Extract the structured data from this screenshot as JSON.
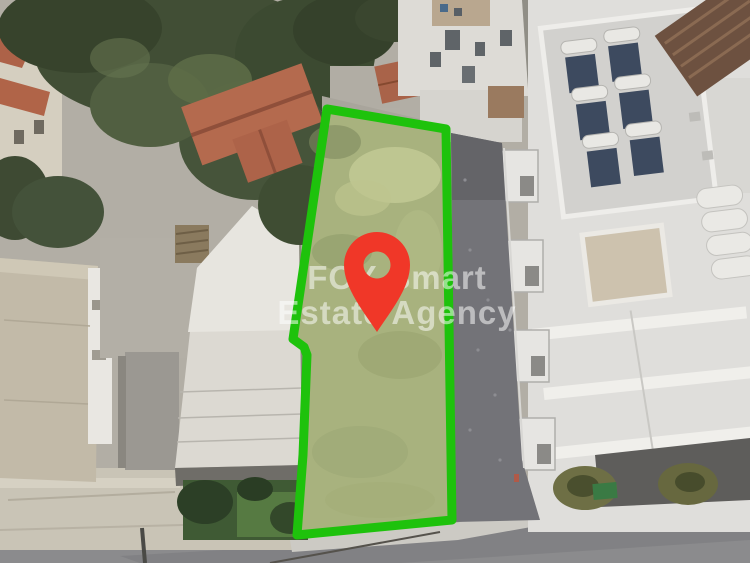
{
  "photo": {
    "type": "aerial-drone-photo",
    "watermark": {
      "line1": "FOX Smart",
      "line2": "Estate Agency",
      "color": "rgba(255,255,255,0.52)"
    },
    "plot": {
      "outline_color": "#1ec20c",
      "fill_color": "#a8b27e"
    },
    "pin": {
      "color": "#f03728"
    }
  }
}
